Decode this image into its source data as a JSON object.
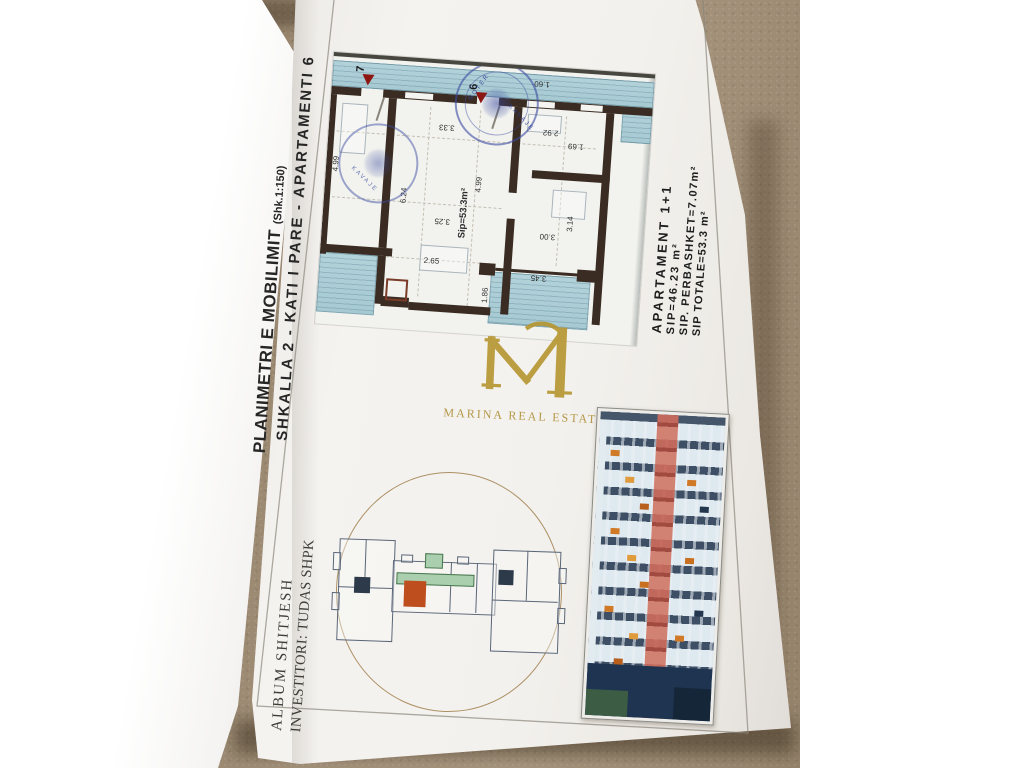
{
  "page": {
    "title": "PLANIMETRI E MOBILIMIT",
    "scale_note": "(Shk.1:150)",
    "subtitle": "SHKALLA 2 - KATI I PARE - APARTAMENTI 6",
    "album_line1": "ALBUM SHITJESH",
    "album_line2": "INVESTITORI: TUDAS SHPK"
  },
  "apartment_info": {
    "name": "APARTAMENT 1+1",
    "sip": "SIP=46.23 m²",
    "perbashket": "SIP. PERBASHKET=7.07m²",
    "totale": "SIP TOTALE=53.3 m²"
  },
  "logo": {
    "monogram": "M",
    "name": "MARINA REAL ESTATE",
    "gold": "#b6952f"
  },
  "floor_plan": {
    "area_label": "Sip=53.3m²",
    "unit7": "7",
    "unit6": "6",
    "stamp": {
      "line1": "NOTER",
      "line2": "KAVAJE"
    },
    "dims": {
      "d499l": "4.99",
      "d624": "6.24",
      "d499m": "4.99",
      "d314": "3.14",
      "d333": "3.33",
      "d292": "2.92",
      "d169": "1.69",
      "d160": "1.60",
      "d325": "3.25",
      "d300": "3.00",
      "d265": "2.65",
      "d345": "3.45",
      "d186": "1.86",
      "d31a": "3.1",
      "d31b": "3.1"
    }
  },
  "colors": {
    "wall": "#3a2c22",
    "balcony_blue": "#b3d2da",
    "stamp_blue": "#4050a8",
    "unit_orange": "#bf4e1e",
    "arrow_red": "#8c1712",
    "circle_tan": "#ad9166",
    "stripe_red": "#c86a5c",
    "carpet": "#98866e"
  }
}
